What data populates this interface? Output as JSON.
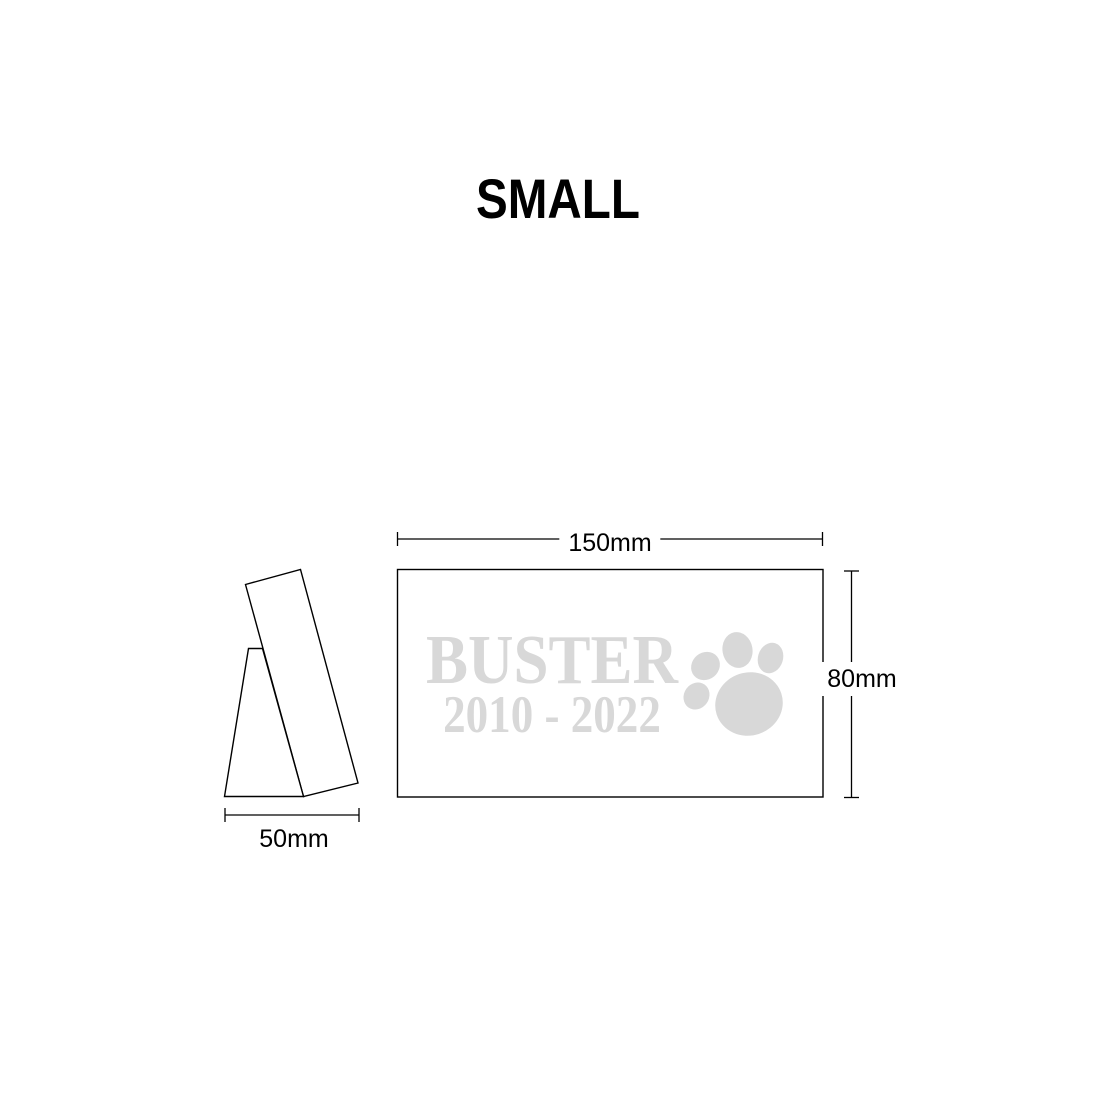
{
  "title": "SMALL",
  "engraving": {
    "name": "BUSTER",
    "years": "2010 - 2022"
  },
  "dimensions": {
    "width": "150mm",
    "height": "80mm",
    "depth": "50mm"
  },
  "icons": {
    "paw": "paw-print-icon"
  },
  "colors": {
    "line": "#000000",
    "engraving": "#d8d8d8",
    "background": "#ffffff"
  }
}
